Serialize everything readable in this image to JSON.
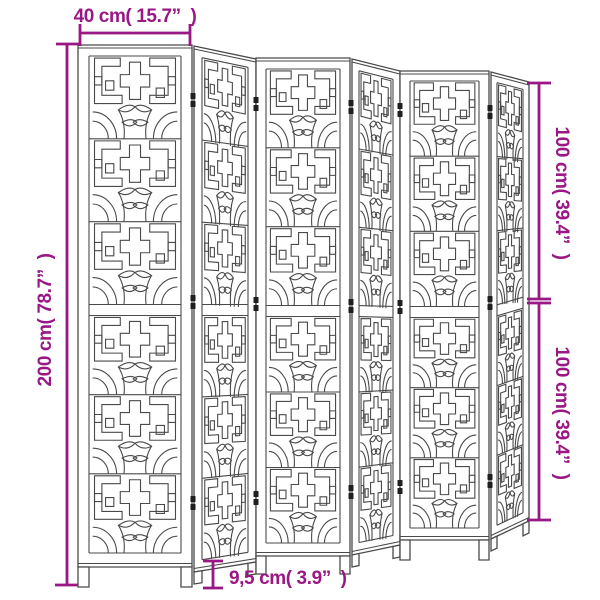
{
  "diagram": {
    "subject": "Room divider with 6 folding panels, ornamental cut-out lattice pattern",
    "panel_count": 6,
    "view": "line-art perspective illustration with dimension callouts"
  },
  "colors": {
    "dimension": "#991885",
    "line": "#4a4a4a",
    "hinge": "#1f1f1f",
    "background": "#ffffff"
  },
  "dimensions": {
    "width": "40 cm( 15.7”  )",
    "height": "200 cm( 78.7”  )",
    "upper_half_height": "100 cm( 39.4”  )",
    "lower_half_height": "100 cm( 39.4”  )",
    "leg_height": "9,5 cm( 3.9”  )"
  }
}
